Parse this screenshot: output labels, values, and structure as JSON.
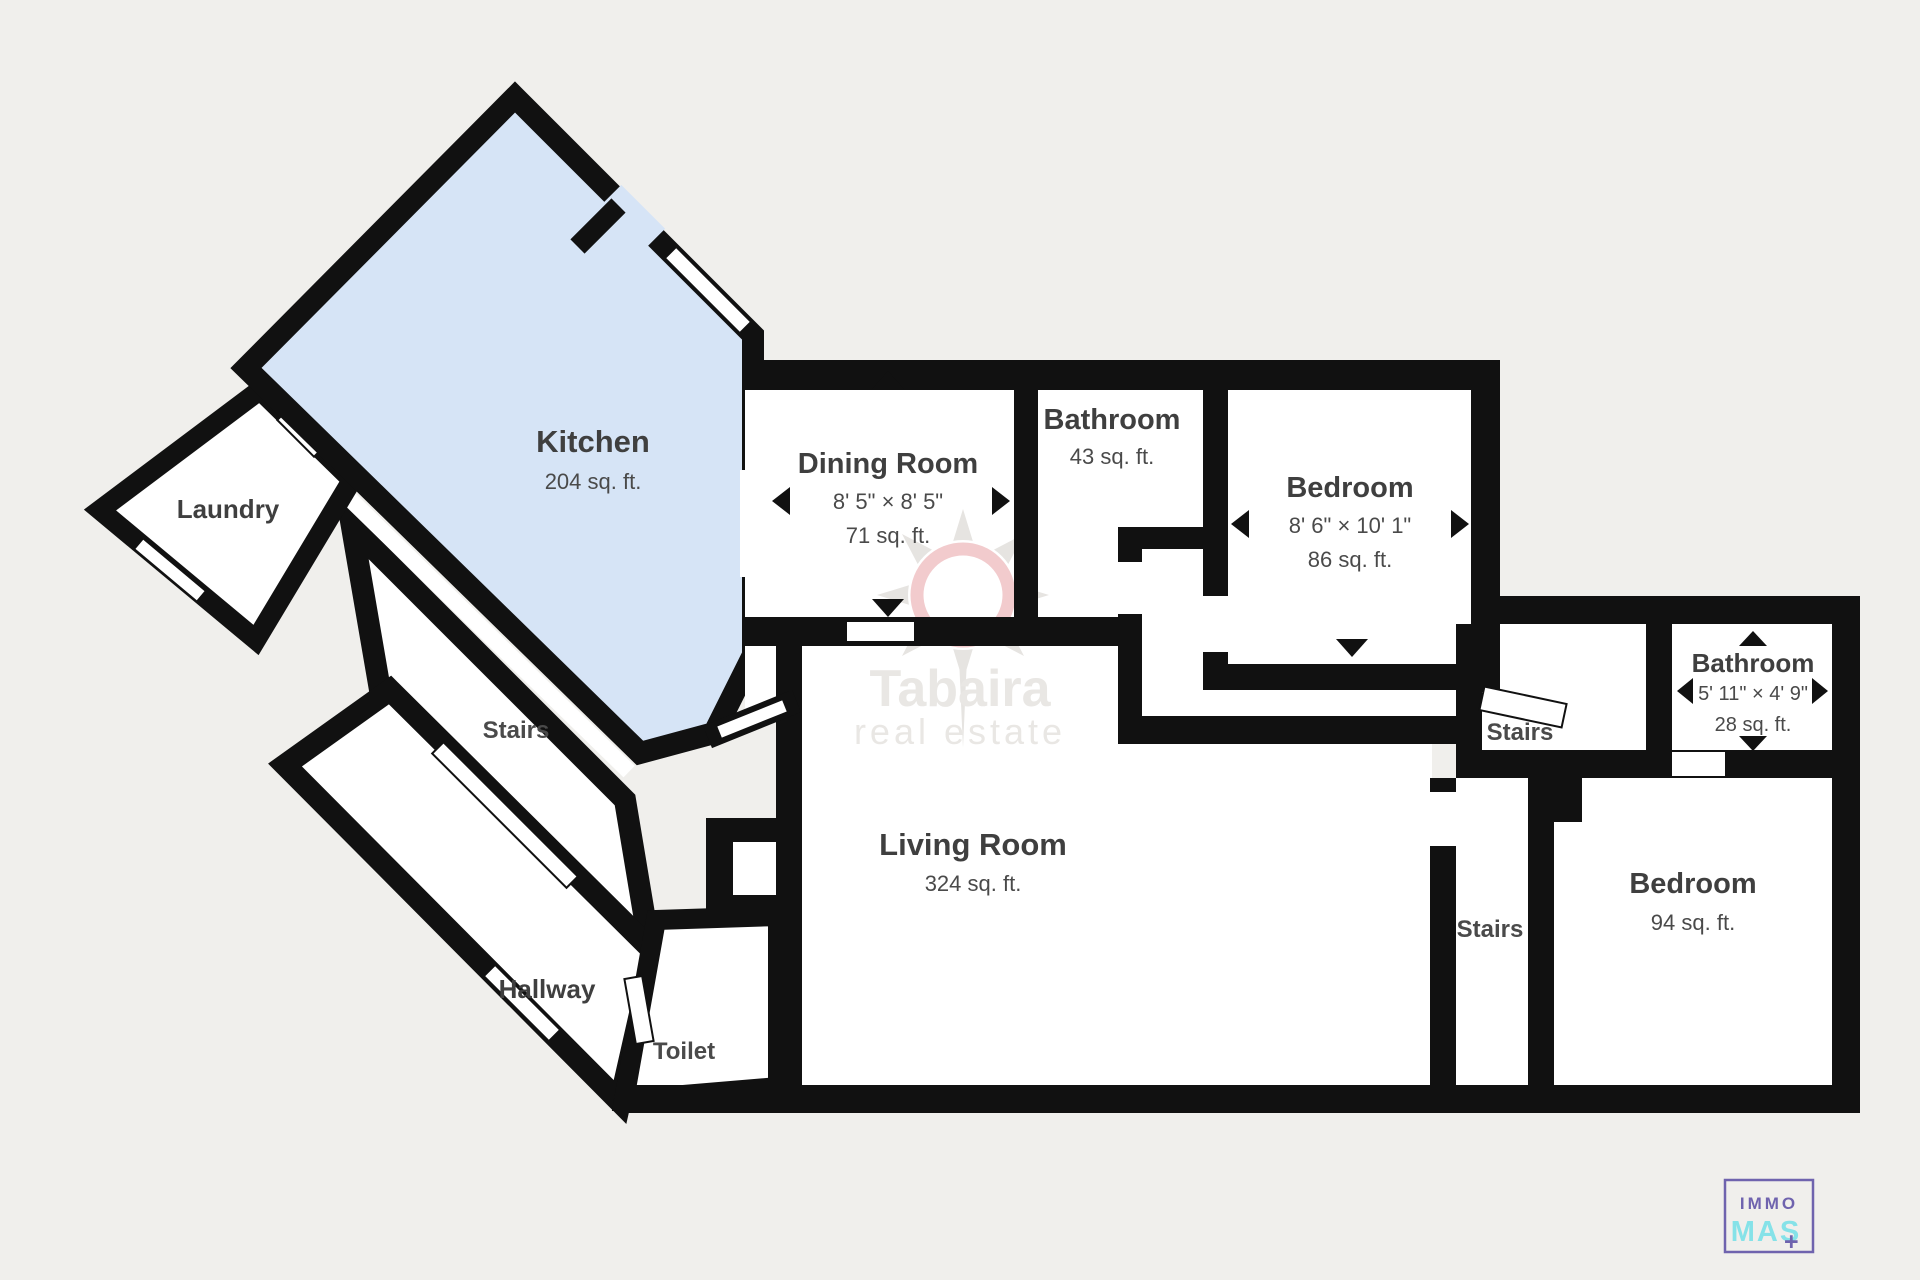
{
  "title": "Floor plan",
  "colors": {
    "background": "#f0efec",
    "wall": "#111111",
    "room_fill": "#ffffff",
    "kitchen_fill": "#d6e4f6",
    "label": "#3f3f3f",
    "sublabel": "#4a4a4a",
    "watermark_gray": "#e9e7e4",
    "sun_ring_pink": "#f2cbcd",
    "logo_purple": "#6f63ae",
    "logo_cyan": "#85e2e8"
  },
  "rooms": {
    "kitchen": {
      "name": "Kitchen",
      "area": "204 sq. ft."
    },
    "laundry": {
      "name": "Laundry"
    },
    "dining": {
      "name": "Dining Room",
      "dims": "8' 5\" × 8' 5\"",
      "area": "71 sq. ft."
    },
    "bathroom_top": {
      "name": "Bathroom",
      "area": "43 sq. ft."
    },
    "bedroom_top": {
      "name": "Bedroom",
      "dims": "8' 6\" × 10' 1\"",
      "area": "86 sq. ft."
    },
    "bathroom_right": {
      "name": "Bathroom",
      "dims": "5' 11\" × 4' 9\"",
      "area": "28 sq. ft."
    },
    "stairs_left": {
      "name": "Stairs"
    },
    "stairs_upper_right": {
      "name": "Stairs"
    },
    "stairs_lower_right": {
      "name": "Stairs"
    },
    "hallway": {
      "name": "Hallway"
    },
    "toilet": {
      "name": "Toilet"
    },
    "living": {
      "name": "Living Room",
      "area": "324 sq. ft."
    },
    "bedroom_right": {
      "name": "Bedroom",
      "area": "94 sq. ft."
    }
  },
  "watermark": {
    "line1": "Tabaira",
    "line2": "real estate"
  },
  "logo": {
    "line1": "IMMO",
    "line2": "MAS",
    "plus": "+"
  }
}
